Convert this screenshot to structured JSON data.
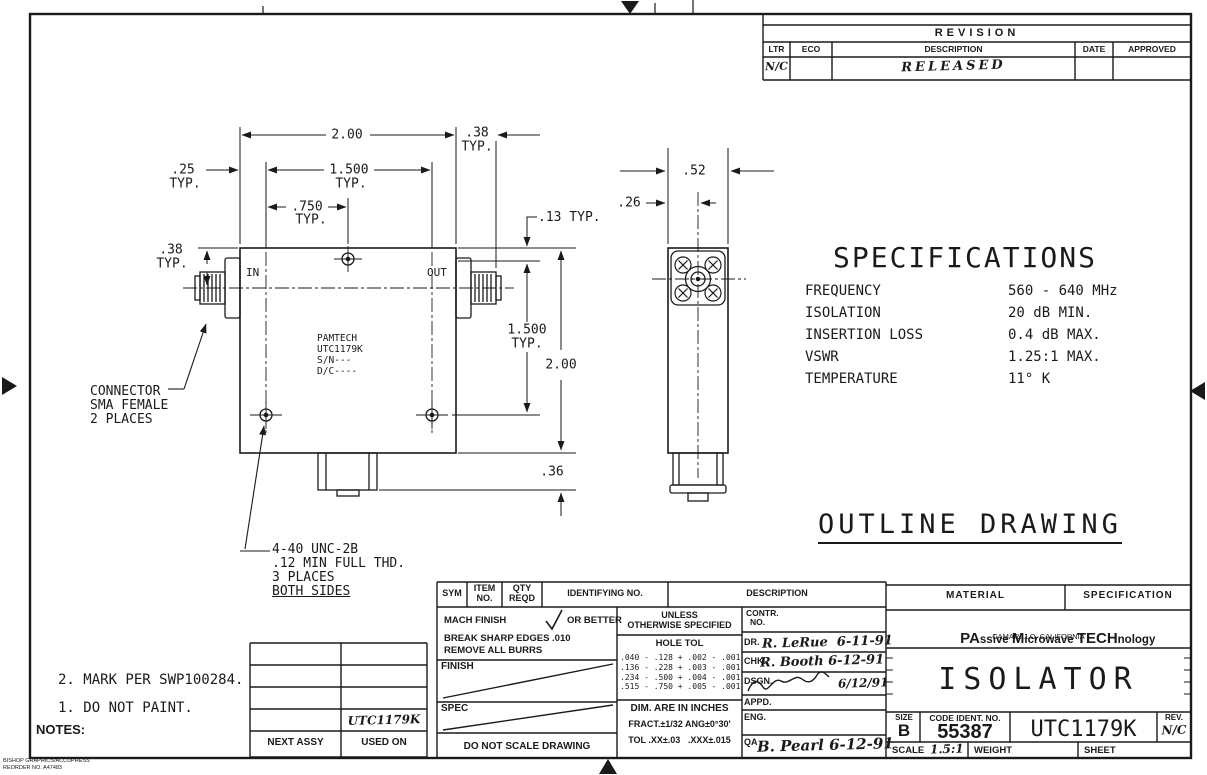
{
  "revision_block": {
    "title": "REVISION",
    "headers": [
      "LTR",
      "ECO",
      "DESCRIPTION",
      "DATE",
      "APPROVED"
    ],
    "entry": {
      "ltr": "N/C",
      "eco": "",
      "description": "RELEASED",
      "date": "",
      "approved": ""
    }
  },
  "specifications": {
    "title": "SPECIFICATIONS",
    "rows": [
      {
        "label": "FREQUENCY",
        "value": "560 - 640 MHz"
      },
      {
        "label": "ISOLATION",
        "value": "20 dB MIN."
      },
      {
        "label": "INSERTION LOSS",
        "value": "0.4 dB MAX."
      },
      {
        "label": "VSWR",
        "value": "1.25:1 MAX."
      },
      {
        "label": "TEMPERATURE",
        "value": "11° K"
      }
    ]
  },
  "drawing_title": "OUTLINE DRAWING",
  "front_view": {
    "port_in": "IN",
    "port_out": "OUT",
    "nameplate": [
      "PAMTECH",
      "UTC1179K",
      "S/N---",
      "D/C----"
    ]
  },
  "dims": {
    "typ": "TYP.",
    "top_width": "2.00",
    "connector_length": ".38",
    "screw_inset": ".25",
    "screw_span_horiz": "1.500",
    "screw_half_span": ".750",
    "hole_edge_offset": ".13 TYP.",
    "connector_center_offset": ".38",
    "screw_span_vert": "1.500",
    "body_height": "2.00",
    "tab_height": ".36",
    "side_width": ".52",
    "side_center_offset": ".26"
  },
  "callouts": {
    "connector": [
      "CONNECTOR",
      "SMA FEMALE",
      "2 PLACES"
    ],
    "thread": [
      "4-40 UNC-2B",
      ".12 MIN FULL THD.",
      "3 PLACES",
      "BOTH SIDES"
    ]
  },
  "notes": {
    "label": "NOTES:",
    "items": [
      "1. DO NOT PAINT.",
      "2. MARK PER SWP100284."
    ]
  },
  "parts_header": {
    "sym": "SYM",
    "item": [
      "ITEM",
      "NO."
    ],
    "qty": [
      "QTY",
      "REQD"
    ],
    "identifying": "IDENTIFYING NO.",
    "description": "DESCRIPTION"
  },
  "finish_block": {
    "mach_prefix": "MACH FINISH",
    "mach_suffix": "OR BETTER",
    "break_edges": "BREAK SHARP EDGES .010",
    "remove_burrs": "REMOVE ALL BURRS",
    "finish_label": "FINISH",
    "spec_label": "SPEC",
    "do_not_scale": "DO NOT SCALE DRAWING"
  },
  "tolerance_block": {
    "unless": [
      "UNLESS",
      "OTHERWISE SPECIFIED"
    ],
    "hole_tol_label": "HOLE TOL",
    "hole_tol_rows": [
      ".040 - .128 + .002 - .001",
      ".136 - .228 + .003 - .001",
      ".234 - .500 + .004 - .001",
      ".515 - .750 + .005 - .001"
    ],
    "dim_units": "DIM. ARE IN INCHES",
    "fract_tol": "FRACT.±1/32 ANG±0°30'",
    "dec_tol": "TOL .XX±.03   .XXX±.015"
  },
  "approval_block": {
    "contr": [
      "CONTR.",
      "NO."
    ],
    "rows": [
      {
        "label": "DR.",
        "value": "R. LeRue  6-11-91"
      },
      {
        "label": "CHK.",
        "value": "R. Booth 6-12-91"
      },
      {
        "label": "DSGN.",
        "value": "6/12/91"
      },
      {
        "label": "APPD.",
        "value": ""
      },
      {
        "label": "ENG.",
        "value": ""
      },
      {
        "label": "QA",
        "value": "B. Pearl 6-12-91"
      }
    ]
  },
  "title_block": {
    "material_label": "MATERIAL",
    "specification_label": "SPECIFICATION",
    "company": {
      "segments": [
        "PA",
        "ssive ",
        "M",
        "icrowave ",
        "TECH",
        "nology"
      ],
      "location": "CAMARILLO, CALIFORNIA"
    },
    "part_title": "ISOLATOR",
    "size": {
      "label": "SIZE",
      "value": "B"
    },
    "code_ident": {
      "label": "CODE IDENT. NO.",
      "value": "55387"
    },
    "drawing_number": "UTC1179K",
    "rev": {
      "label": "REV.",
      "value": "N/C"
    },
    "scale": {
      "label": "SCALE",
      "value": "1.5:1"
    },
    "weight_label": "WEIGHT",
    "sheet_label": "SHEET"
  },
  "next_assy_block": {
    "headers": [
      "NEXT ASSY",
      "USED ON"
    ],
    "used_on_value": "UTC1179K"
  },
  "footer": {
    "line1": "BISHOP GRAPHICS/ACCUPRESS",
    "line2": "REORDER NO. A47483"
  }
}
